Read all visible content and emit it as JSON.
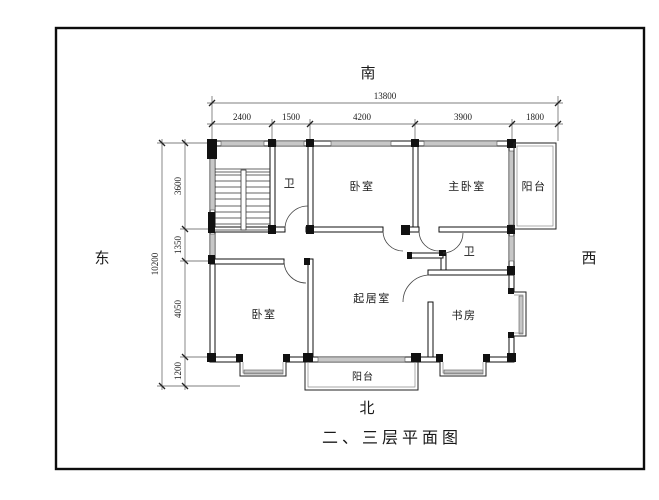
{
  "title": "二、三层平面图",
  "compass": {
    "south": "南",
    "north": "北",
    "east": "东",
    "west": "西"
  },
  "dims": {
    "top_total": "13800",
    "top_segments": [
      "2400",
      "1500",
      "4200",
      "3900",
      "1800"
    ],
    "left_total": "10200",
    "left_segments": [
      "3600",
      "1350",
      "4050",
      "1200"
    ]
  },
  "rooms": {
    "bath_top": "卫",
    "bedroom_top": "卧室",
    "master_bedroom": "主卧室",
    "balcony_east": "阳台",
    "bath_mid": "卫",
    "living_room": "起居室",
    "study": "书房",
    "bedroom_bottom": "卧室",
    "balcony_south": "阳台"
  }
}
